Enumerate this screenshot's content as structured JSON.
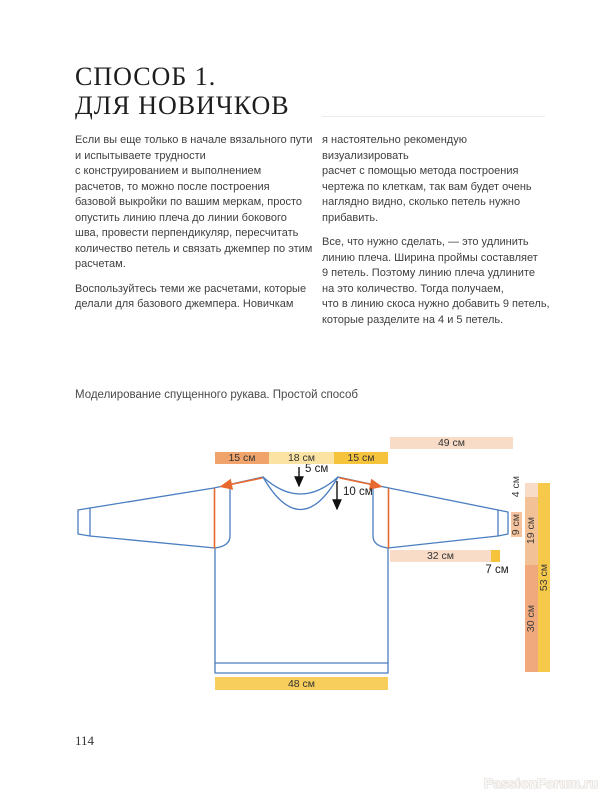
{
  "page": {
    "title_lines": [
      "СПОСОБ 1.",
      "ДЛЯ НОВИЧКОВ"
    ],
    "page_number": "114",
    "watermark": "PassionForum.ru"
  },
  "body": {
    "left_col": {
      "p1_lines": [
        "Если вы еще только в начале вязального пути",
        "и испытываете трудности",
        "с конструированием и выполнением",
        "расчетов, то можно после построения",
        "базовой выкройки по вашим меркам, просто",
        "опустить линию плеча до линии бокового",
        "шва, провести перпендикуляр, пересчитать",
        "количество петель и связать джемпер по этим",
        "расчетам."
      ],
      "p2_lines": [
        "Воспользуйтесь теми же расчетами, которые",
        "делали для базового джемпера. Новичкам"
      ]
    },
    "right_col": {
      "p1_lines": [
        "я настоятельно рекомендую визуализировать",
        "расчет с помощью метода построения",
        "чертежа по клеткам, так вам будет очень",
        "наглядно видно, сколько петель нужно",
        "прибавить."
      ],
      "p2_lines": [
        "Все, что нужно сделать, — это удлинить",
        "линию плеча. Ширина проймы составляет",
        "9 петель. Поэтому линию плеча удлините",
        "на это количество. Тогда получаем,",
        "что в линию скоса нужно добавить 9 петель,",
        "которые разделите на 4 и 5 петель."
      ]
    }
  },
  "figure": {
    "caption": "Моделирование спущенного рукава. Простой способ",
    "measurements": {
      "top_right_bar": "49 см",
      "shoulder_left": "15 см",
      "neck_width": "18 см",
      "shoulder_right": "15 см",
      "back_neck_depth": "5 см",
      "front_neck_depth": "10 см",
      "sleeve_bar": "32 см",
      "sleeve_extra": "7 см",
      "cuff_height": "9 см",
      "shoulder_drop": "4 см",
      "armhole_depth": "19 см",
      "side_length": "30 см",
      "total_length": "53 см",
      "bottom_width": "48 см"
    },
    "colors": {
      "outline_blue": "#4a7ec0",
      "accent_orange": "#e8692e",
      "peach_light": "#f8dcc8",
      "peach_mid": "#f3c196",
      "salmon": "#efa97d",
      "salmon_deep": "#f0a46c",
      "yellow_pale": "#fbe4a3",
      "gold": "#f6c33c",
      "gold_soft": "#f7ce5b",
      "gold_bar": "#f7c94b",
      "cuff_bar": "#f5c49e"
    }
  }
}
